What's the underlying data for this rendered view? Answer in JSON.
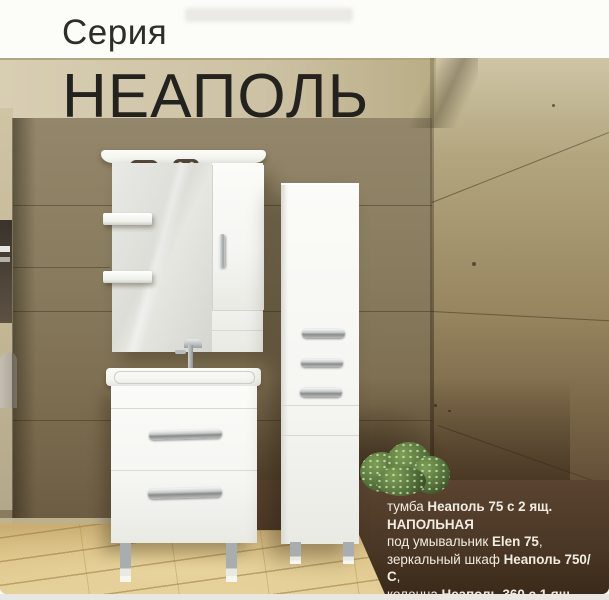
{
  "header": {
    "series_label": "Серия",
    "series_name": "НЕАПОЛЬ"
  },
  "caption": {
    "lines": [
      {
        "normal": "тумба ",
        "bold": "Неаполь 75 с 2 ящ. НАПОЛЬНАЯ",
        "tail": ""
      },
      {
        "normal": "под умывальник ",
        "bold": "Elen 75",
        "tail": ","
      },
      {
        "normal": "зеркальный шкаф ",
        "bold": "Неаполь 750/С",
        "tail": ","
      },
      {
        "normal": "колонна ",
        "bold": "Неаполь 360 с 1 ящ.",
        "tail": ""
      },
      {
        "normal": "цвет: белый глянец",
        "bold": "",
        "tail": ""
      }
    ]
  },
  "colors": {
    "header-bg": "#fcfcf9",
    "title-text": "#2e2d2a",
    "band-left": "#d8ceb3",
    "band-right": "#b9ad86",
    "wall-olive": "#897c5e",
    "wall-olive-dark": "#6b5b42",
    "wall-right-light": "#b3a67f",
    "wall-right-dark": "#5e4a33",
    "floor-light": "#e7d39c",
    "floor-mid": "#d5b97c",
    "panel-brown": "#4c3827",
    "caption-text": "#f1ece2",
    "furniture-white": "#f5f6f2",
    "plant-green": "#53703a"
  }
}
